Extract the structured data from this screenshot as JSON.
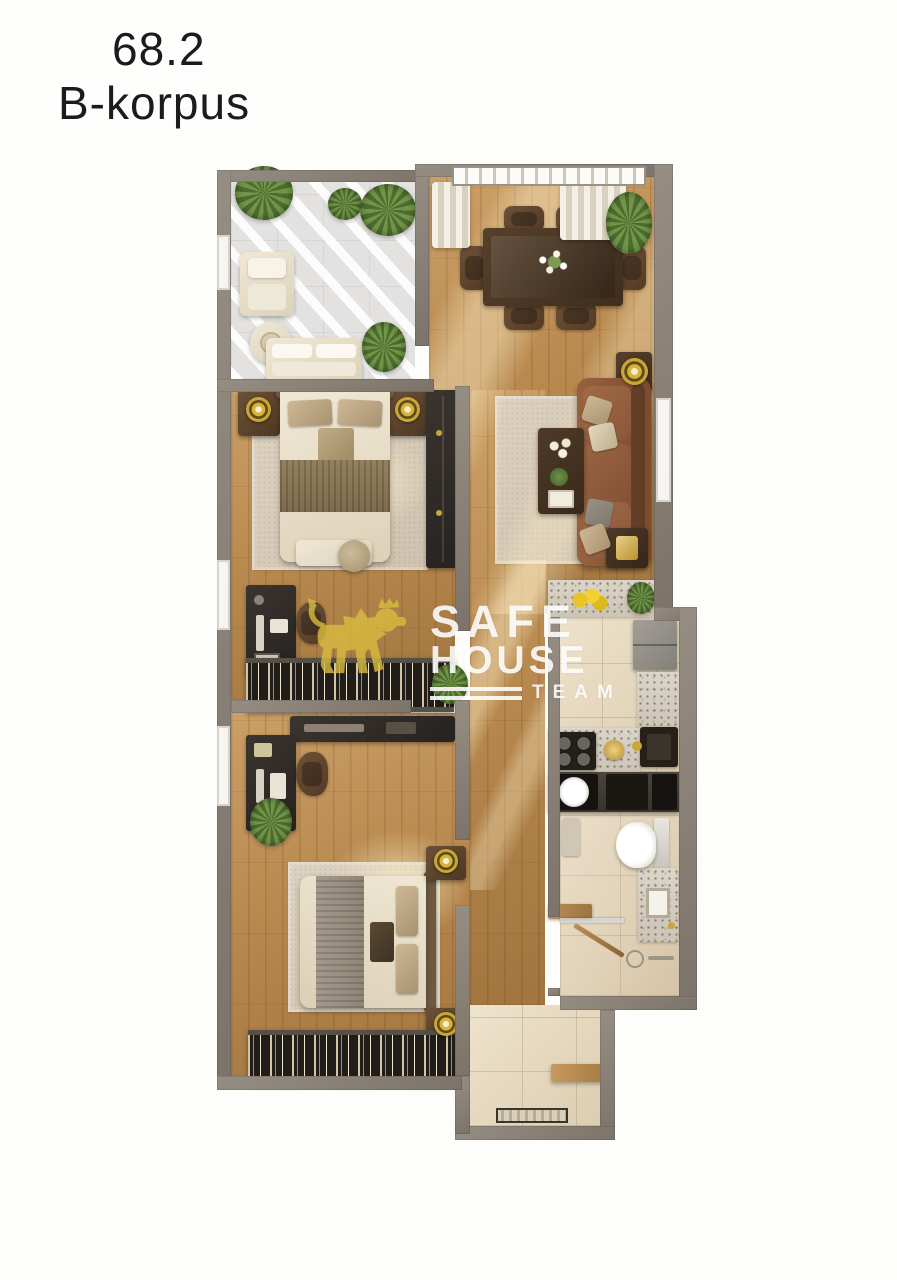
{
  "header": {
    "area_value": "68.2",
    "building_label": "B-korpus"
  },
  "watermark": {
    "brand_top": "SAFE",
    "brand_bottom": "HOUSE",
    "team_label": "TEAM",
    "logo": "lion-logo",
    "logo_color": "#d9bc3f",
    "text_color": "#ffffff"
  },
  "colors": {
    "ink": "#1b1b1b",
    "wall": "#877e74",
    "wood_floor": "#b8894f",
    "balcony_floor": "#e3e2e0",
    "tile_floor": "#e5d8bf",
    "terrazzo": "#d3ccbe",
    "rug": "#d6c9b8",
    "sofa_brown": "#8a5a3b",
    "table_wood_dark": "#4a3628",
    "furniture_dark": "#2e2a25",
    "bed_linen": "#eae1cd",
    "gold_accent": "#c9a637",
    "plant_green": "#5c7f3c",
    "watermark_yellow": "#d9bc3f"
  },
  "floorplan": {
    "type": "apartment-top-view-3d-render",
    "rooms": [
      {
        "name": "terrace-balcony",
        "features": [
          "pergola-shade",
          "lounge-chair",
          "round-side-table",
          "two-seat-sofa",
          "potted-plants"
        ]
      },
      {
        "name": "dining-area",
        "features": [
          "window-blinds",
          "curtains",
          "dining-table",
          "six-chairs",
          "flower-centerpiece",
          "corner-plant"
        ]
      },
      {
        "name": "living-area",
        "features": [
          "leather-sofa",
          "throw-pillows",
          "area-rug",
          "coffee-table",
          "two-lamp-side-tables",
          "window"
        ]
      },
      {
        "name": "bedroom-1",
        "features": [
          "double-bed",
          "two-nightstands",
          "gold-table-lamps",
          "foot-bench",
          "pouf",
          "tall-wardrobe",
          "desk",
          "chair",
          "open-closet-rail",
          "area-rug"
        ]
      },
      {
        "name": "bedroom-2",
        "features": [
          "double-bed",
          "two-nightstands",
          "gold-table-lamps",
          "wall-shelf",
          "desk",
          "chair",
          "potted-plant",
          "open-closet-rail",
          "area-rug"
        ]
      },
      {
        "name": "kitchen",
        "features": [
          "l-shaped-terrazzo-counter",
          "gas-hob",
          "sink",
          "fridge",
          "lemons",
          "plant"
        ]
      },
      {
        "name": "utility-row",
        "features": [
          "washing-machine",
          "built-in-dark-units"
        ]
      },
      {
        "name": "bathroom",
        "features": [
          "toilet",
          "vanity-basin",
          "wood-bench",
          "walk-in-shower",
          "glass-screen"
        ]
      },
      {
        "name": "entry-hall",
        "features": [
          "tile-floor",
          "wood-bench",
          "doormat"
        ]
      },
      {
        "name": "corridor",
        "features": [
          "wood-floor",
          "potted-plant"
        ]
      }
    ]
  }
}
